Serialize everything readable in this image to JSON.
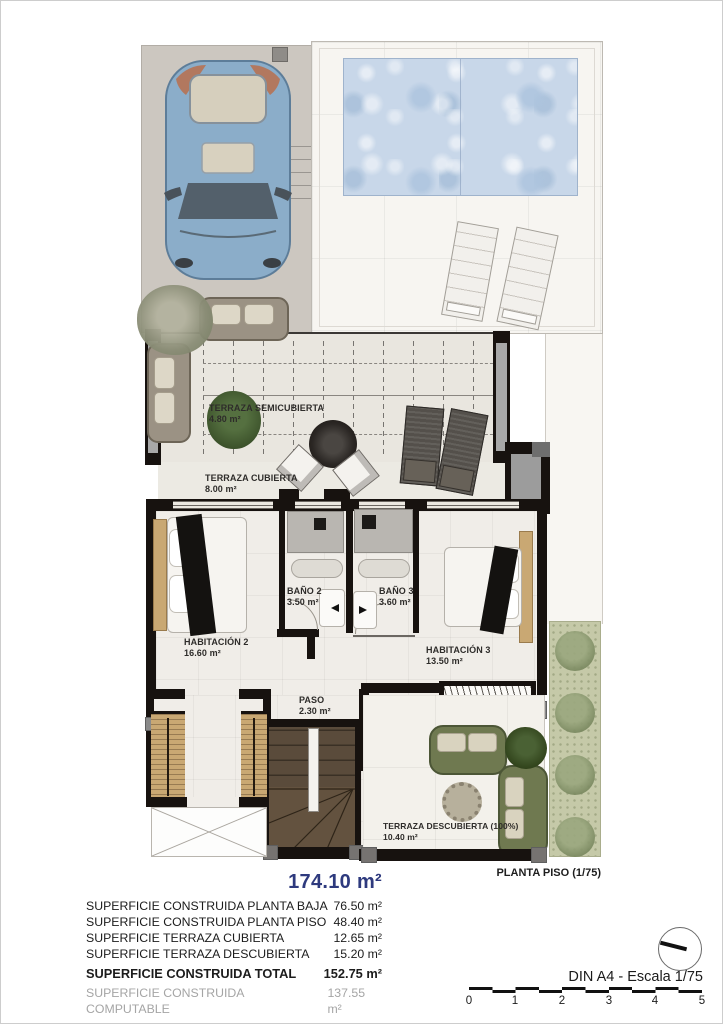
{
  "plan": {
    "caption": "PLANTA PISO (1/75)",
    "rooms": {
      "terraza_semicubierta": {
        "name": "TERRAZA SEMICUBIERTA",
        "area": "4.80 m²"
      },
      "terraza_cubierta": {
        "name": "TERRAZA CUBIERTA",
        "area": "8.00 m²"
      },
      "bano_2": {
        "name": "BAÑO 2",
        "area": "3.50 m²"
      },
      "bano_3": {
        "name": "BAÑO 3",
        "area": "3.60 m²"
      },
      "habitacion_2": {
        "name": "HABITACIÓN 2",
        "area": "16.60 m²"
      },
      "habitacion_3": {
        "name": "HABITACIÓN 3",
        "area": "13.50 m²"
      },
      "paso": {
        "name": "PASO",
        "area": "2.30 m²"
      },
      "terraza_descubierta": {
        "name": "TERRAZA DESCUBIERTA (100%)",
        "area": "10.40 m²"
      }
    }
  },
  "summary": {
    "highlight_value": "174.10 m²",
    "rows": [
      {
        "label": "SUPERFICIE CONSTRUIDA PLANTA BAJA",
        "value": "76.50 m²"
      },
      {
        "label": "SUPERFICIE CONSTRUIDA PLANTA PISO",
        "value": "48.40 m²"
      },
      {
        "label": "SUPERFICIE TERRAZA CUBIERTA",
        "value": "12.65 m²"
      },
      {
        "label": "SUPERFICIE TERRAZA DESCUBIERTA",
        "value": "15.20 m²"
      },
      {
        "label": "SUPERFICIE CONSTRUIDA TOTAL",
        "value": "152.75 m²"
      },
      {
        "label": "SUPERFICIE CONSTRUIDA COMPUTABLE",
        "value": "137.55 m²"
      }
    ]
  },
  "footer": {
    "paper_scale_label": "DIN A4 - Escala 1/75",
    "scale_ticks": [
      "0",
      "1",
      "2",
      "3",
      "4",
      "5"
    ]
  },
  "colors": {
    "highlight_blue": "#2e3a7e",
    "wall_black": "#17120f",
    "pool_blue": "#c8d7e9",
    "garden_green": "#c5c9a8",
    "muted_text": "#a5a5a5"
  }
}
